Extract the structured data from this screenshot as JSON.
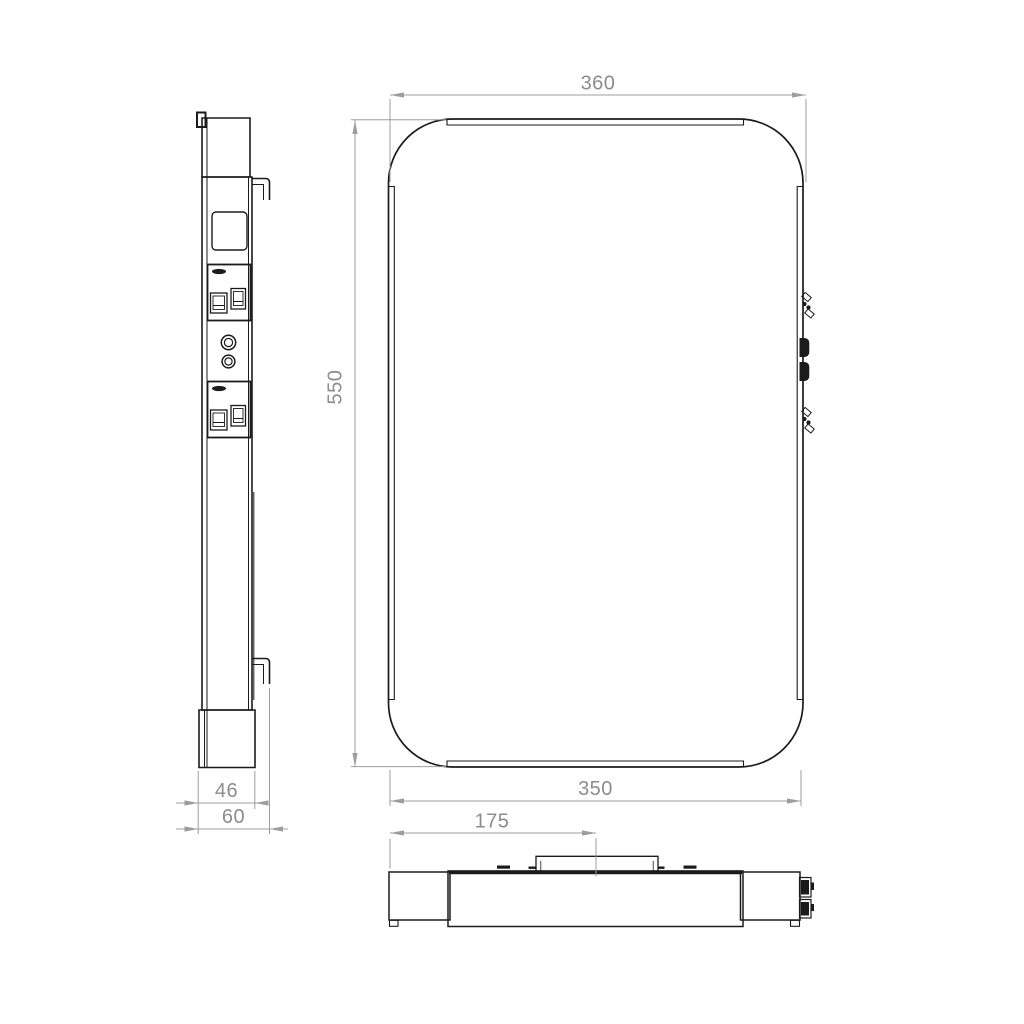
{
  "drawing": {
    "type": "technical-dimension-drawing",
    "views": [
      "side-view",
      "front-view",
      "top-view"
    ]
  },
  "dimensions": {
    "front_width_top": "360",
    "front_height": "550",
    "front_width_bottom": "350",
    "side_depth_body": "46",
    "side_depth_total": "60",
    "top_bracket_offset": "175"
  },
  "colors": {
    "background": "#ffffff",
    "part_line": "#1b1b1b",
    "dimension_line": "#9d9d9d",
    "dimension_text": "#8c8c8c"
  }
}
